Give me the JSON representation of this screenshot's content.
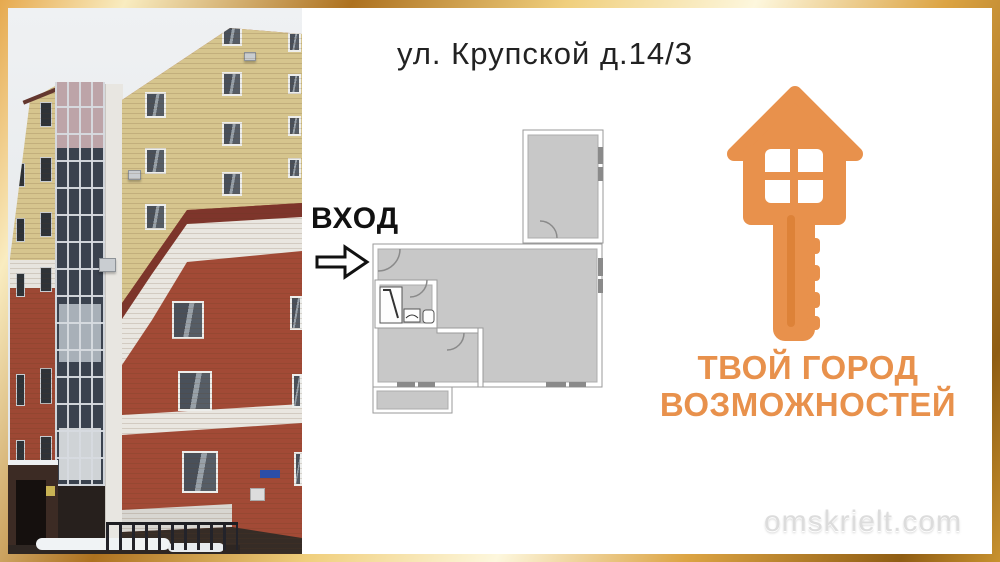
{
  "title": "ул. Крупской д.14/3",
  "plan": {
    "entrance_label": "ВХОД"
  },
  "brand": {
    "slogan_line1": "ТВОЙ ГОРОД",
    "slogan_line2": "ВОЗМОЖНОСТЕЙ",
    "logo": "house-key-icon",
    "accent_color": "#E8914C"
  },
  "watermark": "omskrielt.com",
  "photo": {
    "alt": "Multi-storey brick apartment building in winter"
  },
  "colors": {
    "frame_gold": "#D9A23F",
    "plan_fill": "#C8C8C8",
    "background": "#FFFFFF"
  }
}
